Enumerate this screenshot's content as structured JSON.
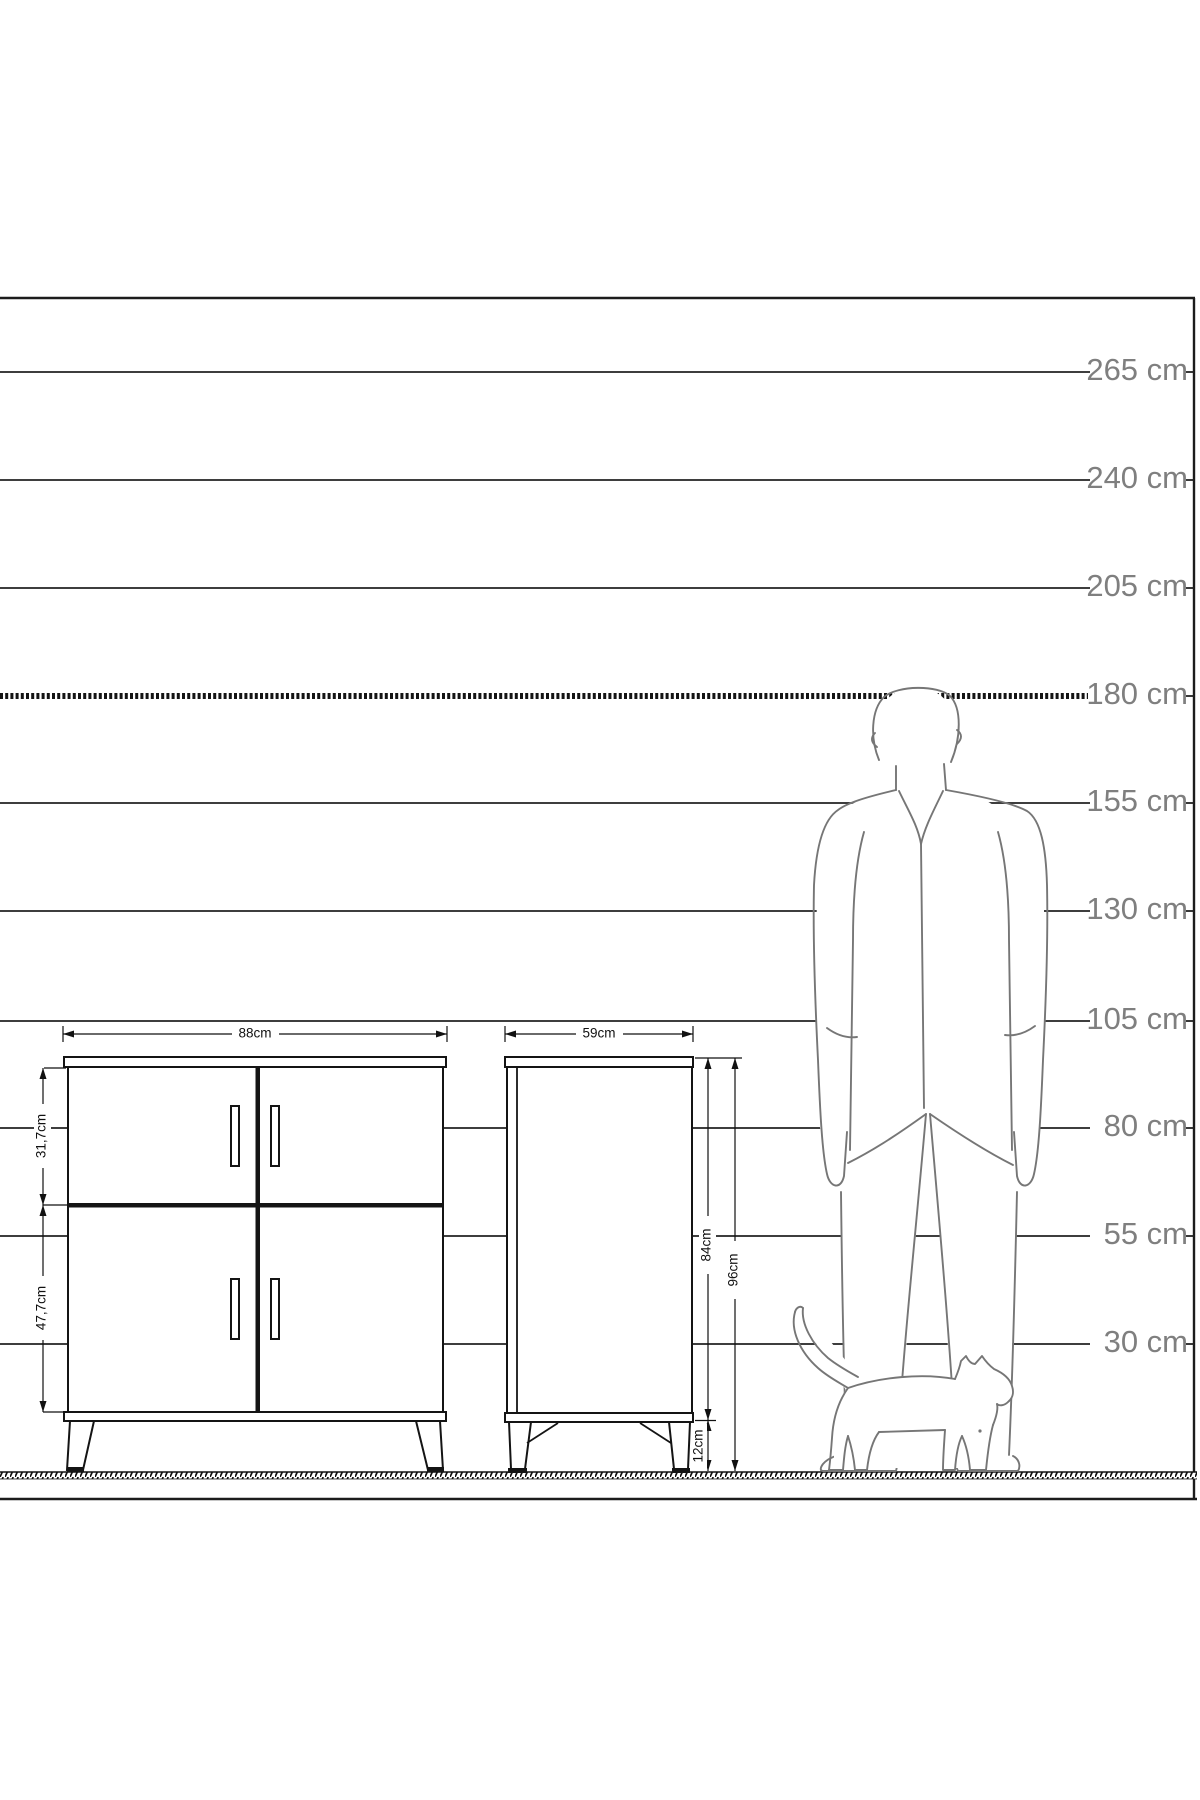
{
  "diagram": {
    "title": "furniture-height-comparison-diagram",
    "ruler": {
      "marks": [
        {
          "label": "265 cm"
        },
        {
          "label": "240 cm"
        },
        {
          "label": "205 cm"
        },
        {
          "label": "180 cm"
        },
        {
          "label": "155 cm"
        },
        {
          "label": "130 cm"
        },
        {
          "label": "105 cm"
        },
        {
          "label": "80 cm"
        },
        {
          "label": "55 cm"
        },
        {
          "label": "30 cm"
        }
      ],
      "reference_line": "180 cm"
    },
    "front_view": {
      "width_label": "88cm",
      "upper_section_label": "31,7cm",
      "lower_section_label": "47,7cm"
    },
    "side_view": {
      "depth_label": "59cm",
      "body_height_label": "84cm",
      "total_height_label": "96cm",
      "leg_height_label": "12cm"
    },
    "colors": {
      "line": "#1c1c1c",
      "ruler_label": "#7f7f7f",
      "figure_outline": "#767676",
      "background": "#ffffff"
    }
  }
}
